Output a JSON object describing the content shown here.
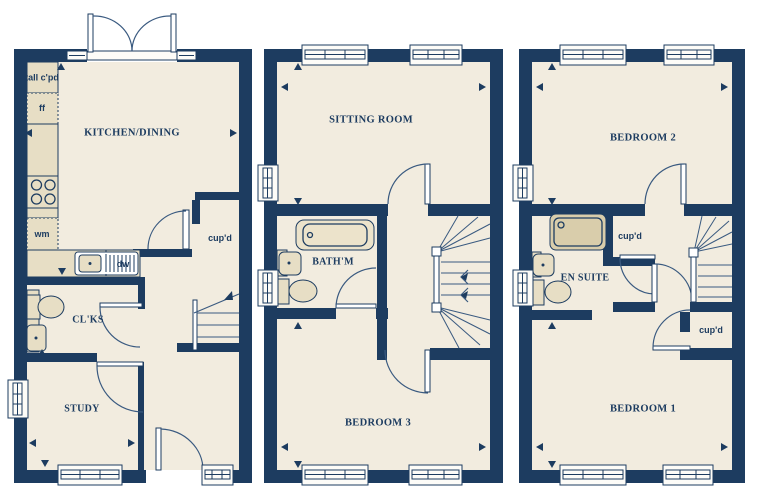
{
  "palette": {
    "wall": "#1d3c60",
    "floor": "#f2ecdf",
    "fixture": "#e7dec5",
    "fixture_dark": "#d9cdab",
    "fixture_light": "#ece3cb",
    "line": "#3a5a80",
    "window": "#fdfcf8",
    "text": "#1d3c60"
  },
  "labels": {
    "ground": {
      "kitchen": "KITCHEN/DINING",
      "tall_cupboard": "tall c'pd",
      "fridge_freezer": "ff",
      "washing_machine": "wm",
      "dishwasher": "dw",
      "cupboard": "cup'd",
      "cloakroom": "CL'KS",
      "study": "STUDY"
    },
    "first": {
      "sitting_room": "SITTING ROOM",
      "bathroom": "BATH'M",
      "bedroom3": "BEDROOM 3"
    },
    "second": {
      "bedroom2": "BEDROOM 2",
      "ensuite": "EN SUITE",
      "cupboard_top": "cup'd",
      "cupboard_bottom": "cup'd",
      "bedroom1": "BEDROOM 1"
    }
  }
}
